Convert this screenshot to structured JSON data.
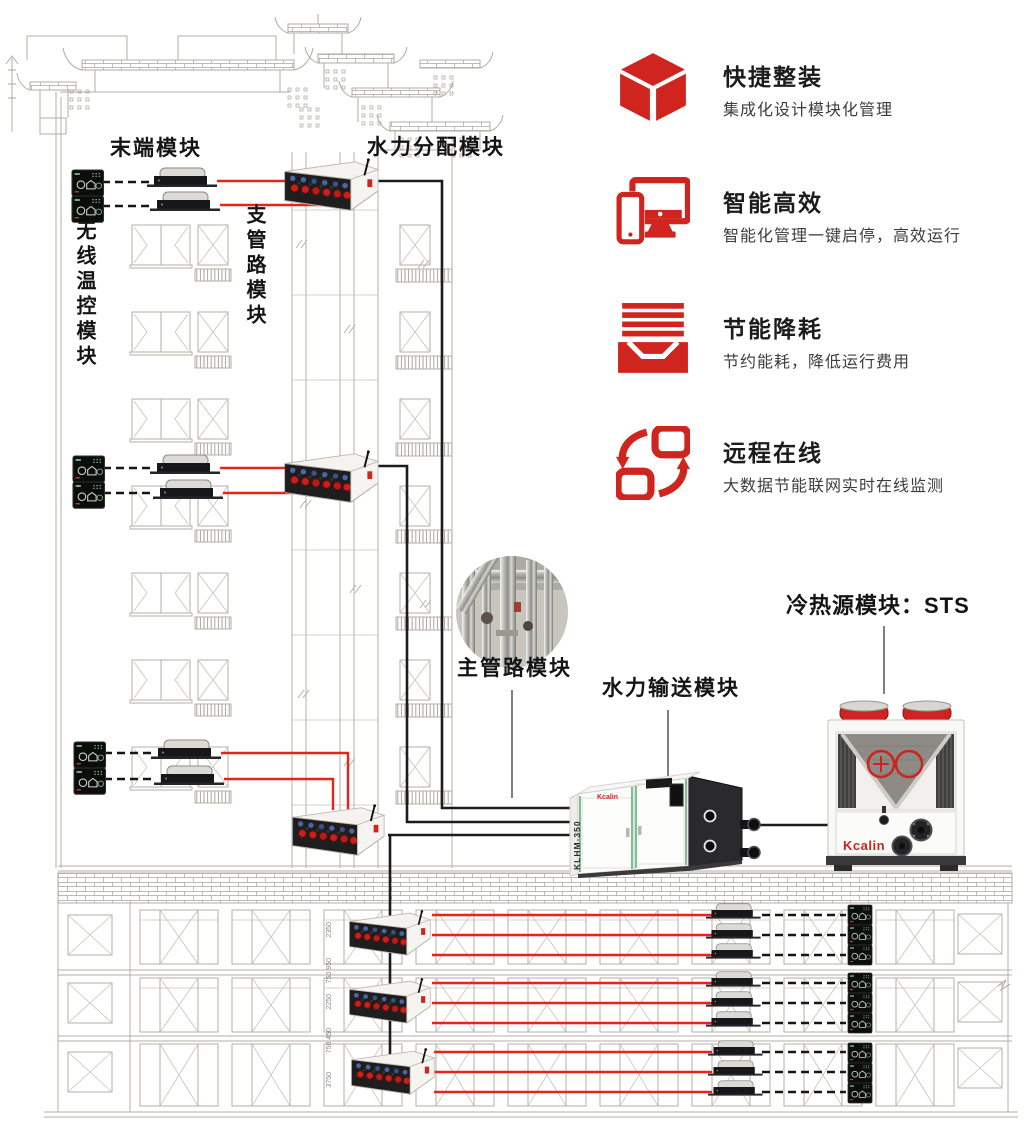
{
  "colors": {
    "accent_red": "#d0241f",
    "pipe_red": "#e8231a",
    "pipe_black": "#1c1c1c",
    "drawing_gray": "#b6afa7"
  },
  "features": [
    {
      "icon": "cube-icon",
      "title": "快捷整装",
      "subtitle": "集成化设计模块化管理"
    },
    {
      "icon": "devices-icon",
      "title": "智能高效",
      "subtitle": "智能化管理一键启停，高效运行"
    },
    {
      "icon": "layers-tray-icon",
      "title": "节能降耗",
      "subtitle": "节约能耗，降低运行费用"
    },
    {
      "icon": "sync-arrows-icon",
      "title": "远程在线",
      "subtitle": "大数据节能联网实时在线监测"
    }
  ],
  "module_labels": {
    "terminal": "末端模块",
    "distribution": "水力分配模块",
    "branch": "支管路模块",
    "wireless": "无线温控模块",
    "main_pipe": "主管路模块",
    "transport": "水力输送模块",
    "source": "冷热源模块：STS"
  },
  "equipment": {
    "pump_model": "KLHM-350",
    "brand": "Kcalin"
  },
  "dimensions": [
    "2350",
    "750 950",
    "2250",
    "750 450",
    "3750"
  ]
}
